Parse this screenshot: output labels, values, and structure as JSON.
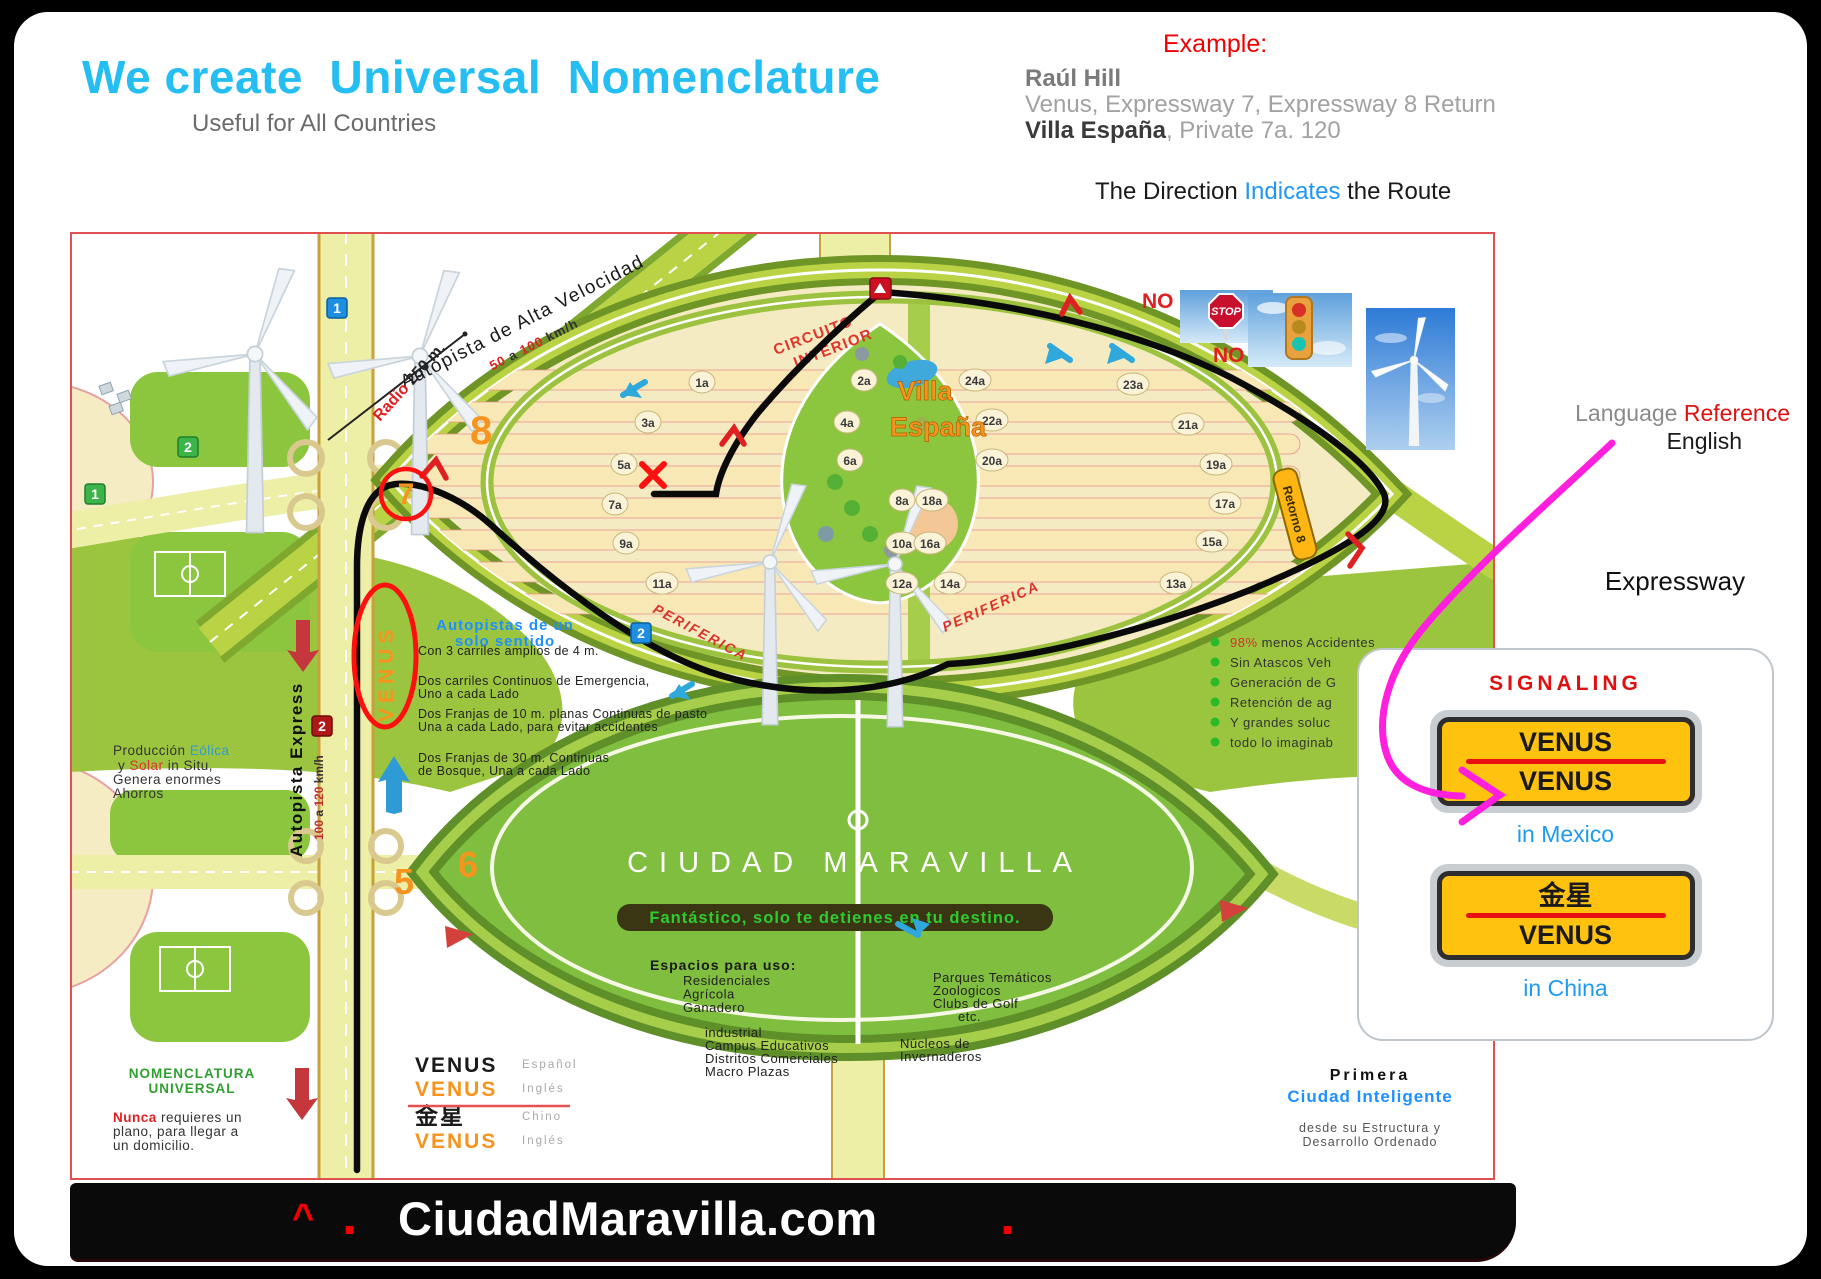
{
  "header": {
    "title": "We create  Universal  Nomenclature",
    "subtitle": "Useful for All Countries"
  },
  "example": {
    "label": "Example:",
    "name": "Raúl Hill",
    "line1": "Venus, Expressway 7, Expressway 8 Return",
    "line2_strong": "Villa España",
    "line2_rest": ", Private 7a. 120",
    "direction_pre": "The Direction ",
    "direction_blue": "Indicates",
    "direction_post": " the Route"
  },
  "right_panel": {
    "language_gray": "Language ",
    "language_red": "Reference",
    "english": "English",
    "expressway": "Expressway",
    "signaling_title": "SIGNALING",
    "sign_mexico_top": "VENUS",
    "sign_mexico_bottom": "VENUS",
    "mexico_caption": "in Mexico",
    "sign_china_top": "金星",
    "sign_china_bottom": "VENUS",
    "china_caption": "in China",
    "sign_yellow": "#FFC20E",
    "accent_red": "#E01010",
    "accent_blue": "#1E9BF0"
  },
  "map": {
    "autopista_alta": "Autopista de Alta Velocidad",
    "speed_top": {
      "n1": "50",
      "mid": " a ",
      "n2": "100",
      "unit": "  km/h"
    },
    "radio_red": "Radio",
    "radio_black": " 250 m.",
    "num8": "8",
    "num7": "7",
    "num6": "6",
    "num5": "5",
    "circuito_1": "CIRCUITO",
    "circuito_2": "INTERIOR",
    "villa_1": "Villa",
    "villa_2": "España",
    "periferica": "PERIFERICA",
    "no": "NO",
    "stop": "STOP",
    "retorno": "Retorno 8",
    "streets": [
      "1a",
      "2a",
      "24a",
      "3a",
      "4a",
      "22a",
      "5a",
      "6a",
      "20a",
      "7a",
      "8a",
      "18a",
      "9a",
      "10a",
      "16a",
      "11a",
      "12a",
      "14a",
      "23a",
      "21a",
      "19a",
      "17a",
      "15a",
      "13a"
    ],
    "badges": {
      "blue_top": "1",
      "green_top": "2",
      "green_left": "1",
      "red_left": "2",
      "blue_route": "2"
    },
    "venus_vertical": "VENUS",
    "oneway_title_1": "Autopistas de un",
    "oneway_title_2": "solo sentido",
    "oneway_lines": [
      "Con 3 carriles amplios de 4 m.",
      "Dos carriles Continuos de Emergencia,",
      "Uno a cada Lado",
      "Dos Franjas de 10 m. planas Continuas de pasto",
      "Una a cada Lado, para evitar accidentes",
      "Dos Franjas de 30 m. Continuas",
      "de Bosque, Una a cada Lado"
    ],
    "express_label": "Autopista Express",
    "speed_left": {
      "n1": "100",
      "mid": " a ",
      "n2": "120",
      "unit": " km/h"
    },
    "produccion": {
      "l1a": "Producción ",
      "l1b": "Eólica",
      "l2a": "y ",
      "l2b": "Solar",
      "l2c": " in Situ,",
      "l3": "Genera enormes",
      "l4": "Ahorros"
    },
    "benefits_red": "98%",
    "benefits_first_rest": " menos Accidentes",
    "benefits": [
      "Sin Atascos Veh",
      "Generación de G",
      "Retención de ag",
      "Y grandes soluc",
      "todo lo imaginab"
    ],
    "ciudad_title": "CIUDAD MARAVILLA",
    "banner": "Fantástico, solo te detienes en tu destino.",
    "espacios_title": "Espacios para uso:",
    "uses_1": [
      "Residenciales",
      "Agrícola",
      "Ganadero"
    ],
    "uses_2": [
      "industrial",
      "Campus Educativos",
      "Distritos Comerciales",
      "Macro Plazas"
    ],
    "uses_3": [
      "Parques Temáticos",
      "Zoologicos",
      "Clubs de Golf",
      "etc."
    ],
    "uses_4": [
      "Núcleos de",
      "Invernaderos"
    ],
    "nomenclatura_1": "NOMENCLATURA",
    "nomenclatura_2": "UNIVERSAL",
    "nunca_red": "Nunca",
    "nunca_l1": " requieres un",
    "nunca_l2": "plano, para llegar a",
    "nunca_l3": "un domicilio.",
    "lang_rows": [
      {
        "word": "VENUS",
        "lang": "Español",
        "color": "#1a1a1a"
      },
      {
        "word": "VENUS",
        "lang": "Inglés",
        "color": "#F7941D"
      },
      {
        "word": "金星",
        "lang": "Chino",
        "color": "#1a1a1a"
      },
      {
        "word": "VENUS",
        "lang": "Inglés",
        "color": "#F7941D"
      }
    ],
    "primera": "Primera",
    "ciudad_inteligente": "Ciudad Inteligente",
    "desde_1": "desde su Estructura y",
    "desde_2": "Desarrollo Ordenado"
  },
  "footer": {
    "caret": "^",
    "dot1": ".",
    "site": "CiudadMaravilla.com",
    "dot2": "."
  }
}
